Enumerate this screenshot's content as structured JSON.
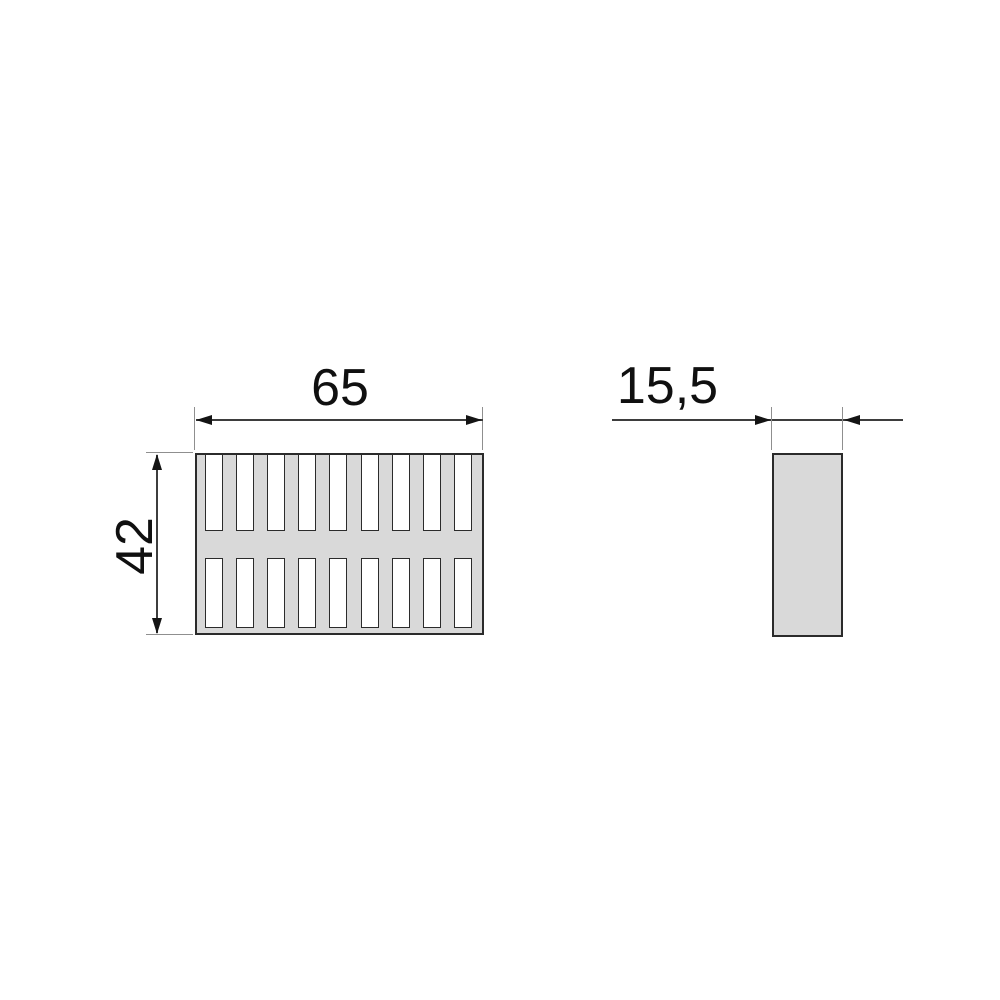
{
  "drawing": {
    "title": "slotted grille profile — dimensioned technical drawing",
    "dimensions": {
      "width_label": "65",
      "height_label": "42",
      "depth_label": "15,5"
    },
    "front_view": {
      "slot_rows": 2,
      "slots_per_row": 9,
      "slot_pitch_px": 31.1,
      "slot_width_px": 18,
      "first_slot_offset_px": 8
    },
    "side_view": {
      "shape": "plain rectangle"
    },
    "colors": {
      "body_fill": "#d9d9d9",
      "slot_fill": "#ffffff",
      "outline": "#2b2b2b",
      "dimension_line": "#3d3d3d",
      "extension_line": "#8f8f8f",
      "arrow": "#141414",
      "text": "#101010",
      "background": "#ffffff"
    }
  }
}
